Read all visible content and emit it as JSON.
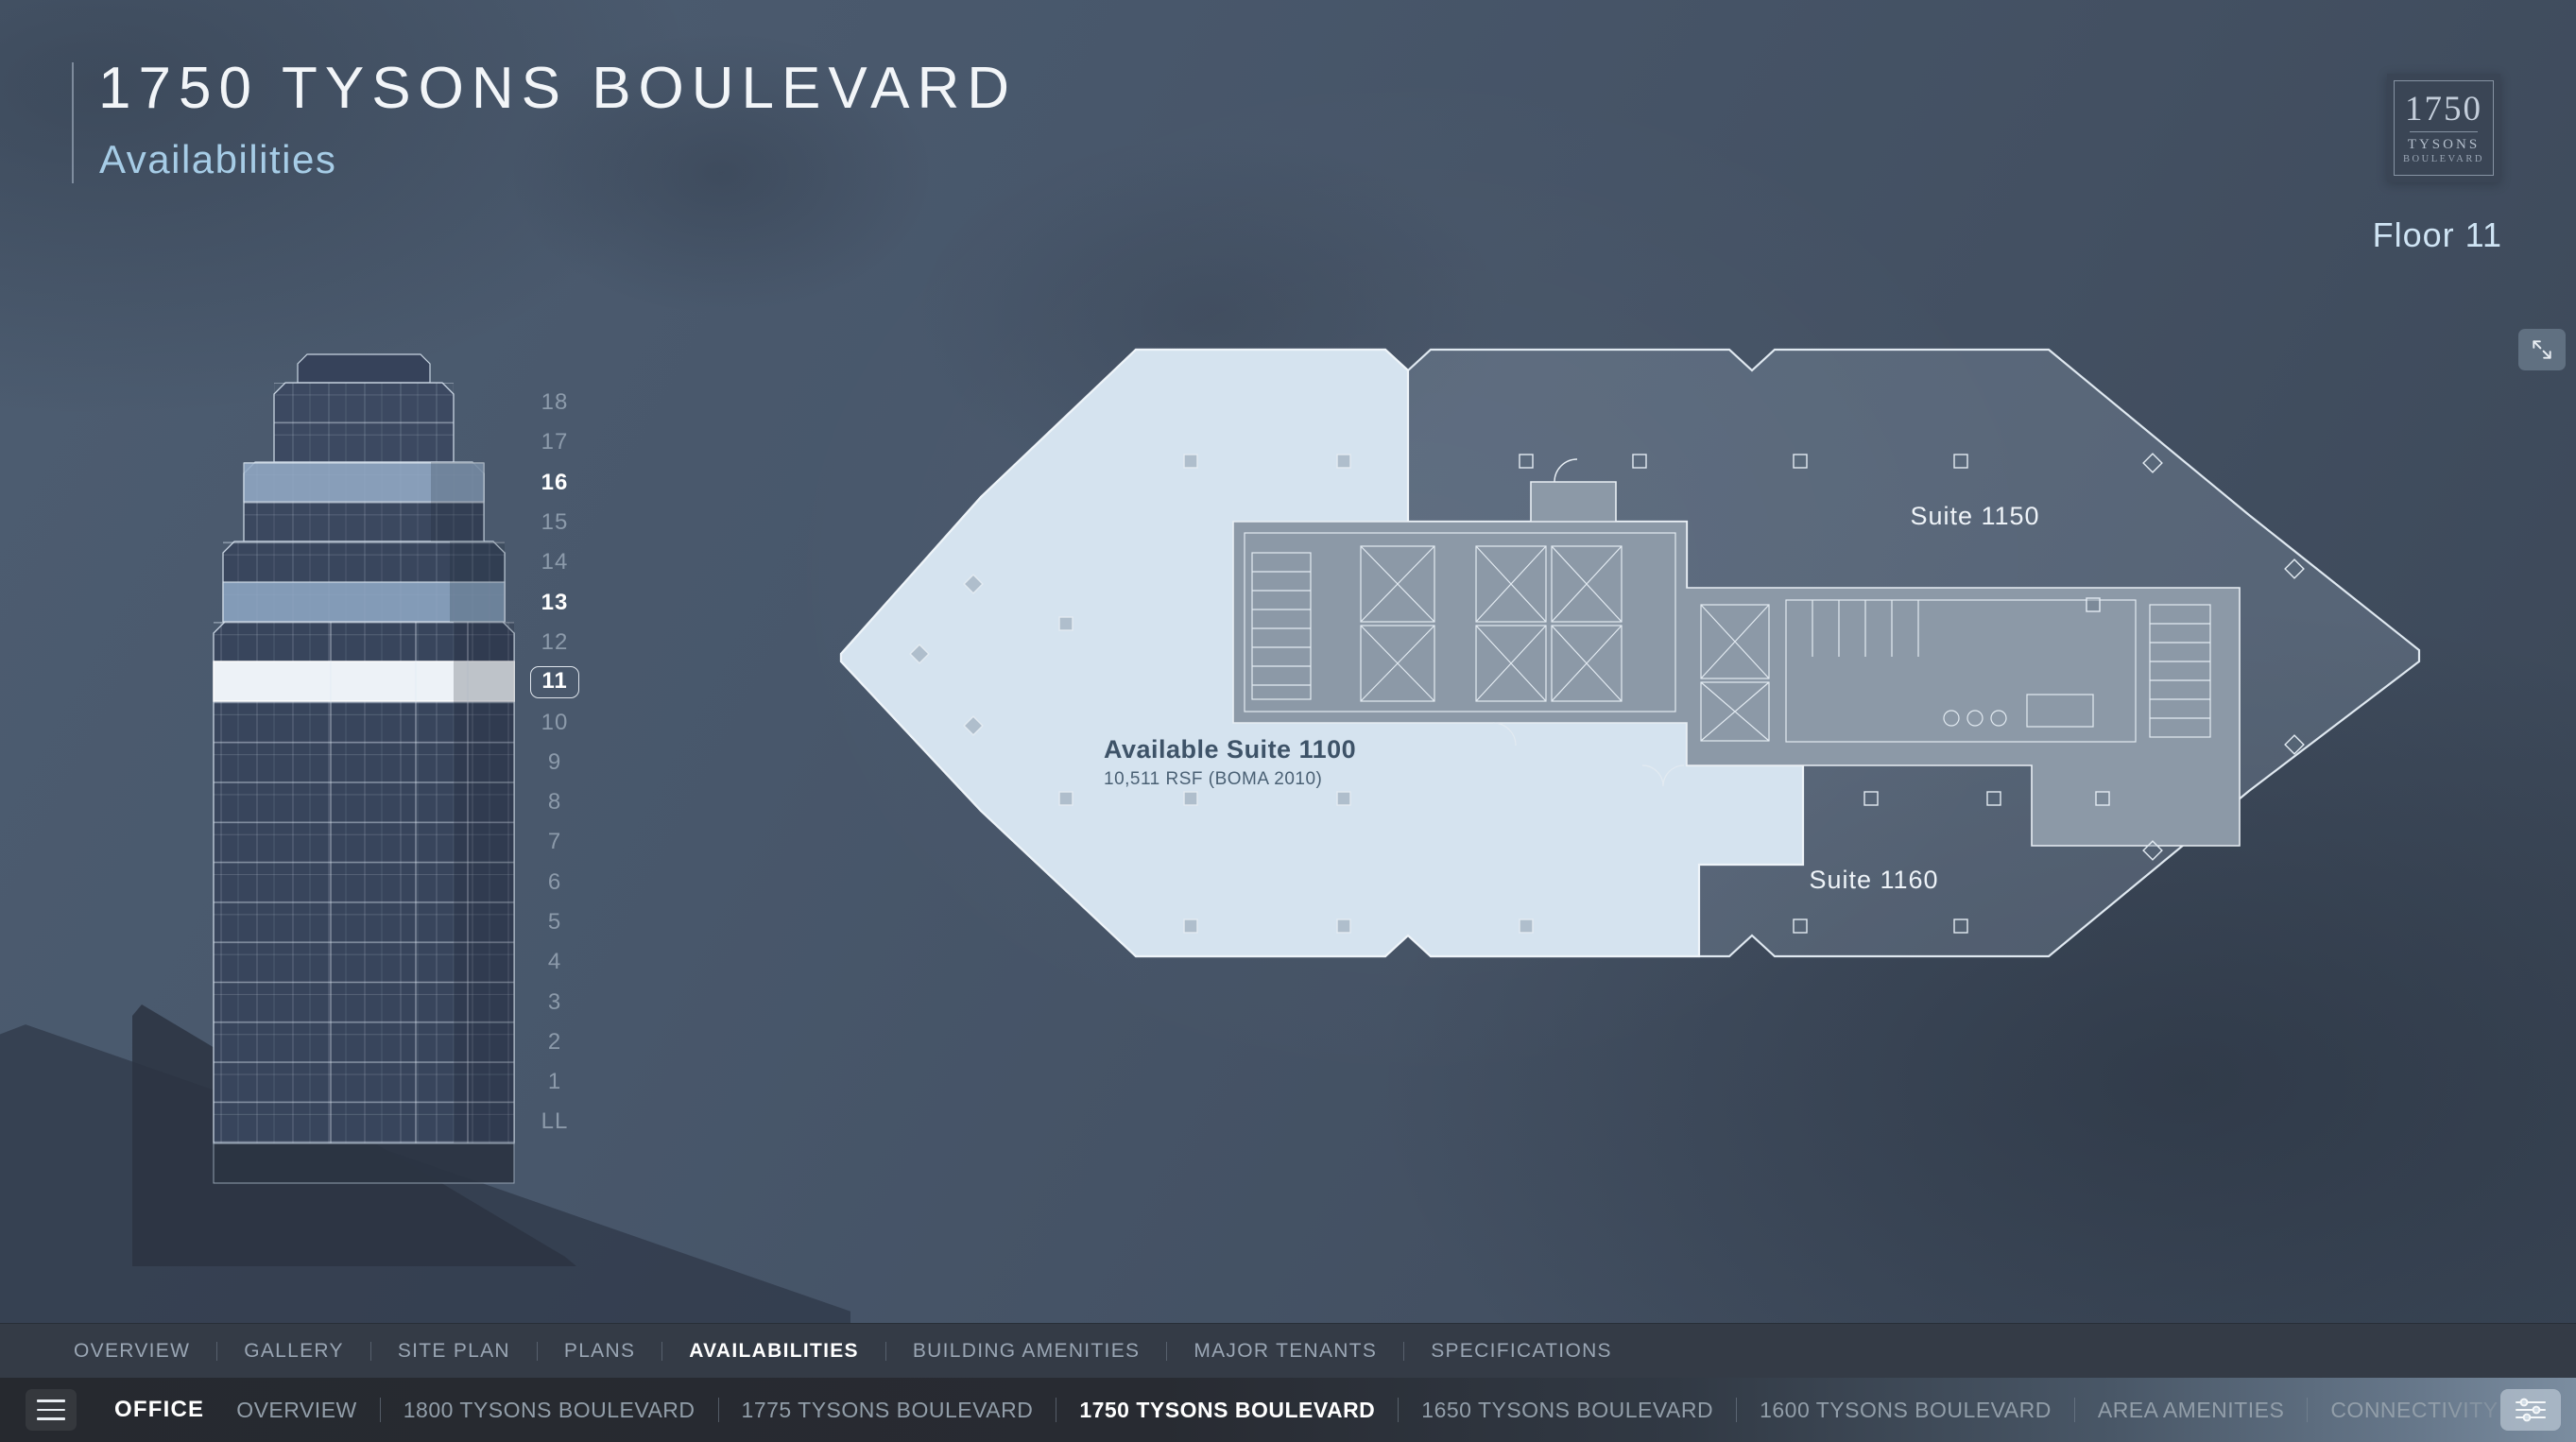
{
  "header": {
    "title": "1750 TYSONS BOULEVARD",
    "subtitle": "Availabilities"
  },
  "logo": {
    "number": "1750",
    "line2": "TYSONS",
    "line3": "BOULEVARD"
  },
  "floor_indicator": {
    "label": "Floor 11"
  },
  "building": {
    "floors": [
      "18",
      "17",
      "16",
      "15",
      "14",
      "13",
      "12",
      "11",
      "10",
      "9",
      "8",
      "7",
      "6",
      "5",
      "4",
      "3",
      "2",
      "1",
      "LL"
    ],
    "available_floors": [
      "16",
      "13",
      "11"
    ],
    "selected_floor": "11"
  },
  "floorplan": {
    "suites": [
      {
        "name": "Suite 1150"
      },
      {
        "name": "Available Suite 1100",
        "size": "10,511 RSF (BOMA 2010)",
        "available": true
      },
      {
        "name": "Suite 1160"
      }
    ]
  },
  "section_nav": {
    "items": [
      {
        "label": "OVERVIEW",
        "active": false
      },
      {
        "label": "GALLERY",
        "active": false
      },
      {
        "label": "SITE PLAN",
        "active": false
      },
      {
        "label": "PLANS",
        "active": false
      },
      {
        "label": "AVAILABILITIES",
        "active": true
      },
      {
        "label": "BUILDING AMENITIES",
        "active": false
      },
      {
        "label": "MAJOR TENANTS",
        "active": false
      },
      {
        "label": "SPECIFICATIONS",
        "active": false
      }
    ]
  },
  "bottom_bar": {
    "category": "OFFICE",
    "items": [
      {
        "label": "OVERVIEW",
        "active": false
      },
      {
        "label": "1800 TYSONS BOULEVARD",
        "active": false
      },
      {
        "label": "1775 TYSONS BOULEVARD",
        "active": false
      },
      {
        "label": "1750 TYSONS BOULEVARD",
        "active": true
      },
      {
        "label": "1650 TYSONS BOULEVARD",
        "active": false
      },
      {
        "label": "1600 TYSONS BOULEVARD",
        "active": false
      },
      {
        "label": "AREA AMENITIES",
        "active": false
      },
      {
        "label": "CONNECTIVITY",
        "active": false
      }
    ]
  },
  "colors": {
    "background": "#47566a",
    "available_suite_fill": "#d9e7f3",
    "selected_floor_band": "#edf2f7",
    "available_floor_band": "#93aac6",
    "subtitle_accent": "#a6cce6",
    "nav_bar": "#343b46",
    "bottom_bar": "#282b32"
  }
}
